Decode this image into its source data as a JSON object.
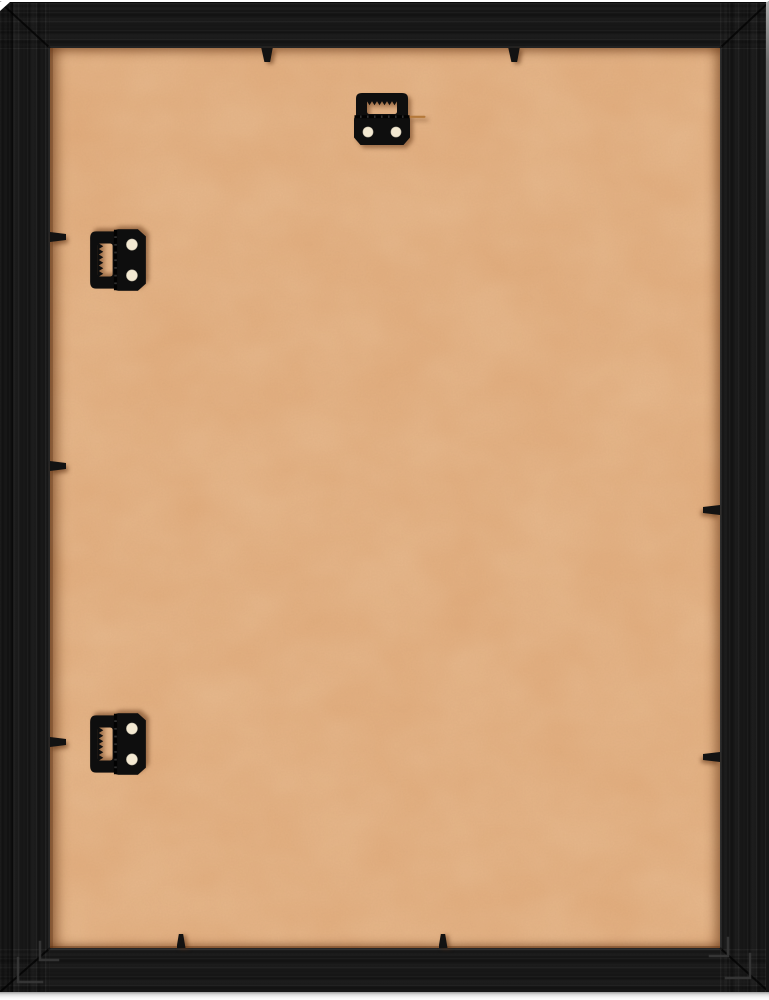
{
  "scene": {
    "description": "Back view of a black wood picture frame: a tan MDF backing board is held in by small black flex tabs around the opening; one horizontal sawtooth hanger is mounted at top center and two vertical sawtooth hangers along the left edge; v-nail staples are visible at the mitered corners; white backdrop shows as thin slivers at the top and bottom edges.",
    "colors": {
      "background": "#ffffff",
      "frame": "#181818",
      "backing": "#e0aa7b",
      "hardware": "#0e0e0e",
      "screw_hole": "#f3e9d2",
      "spur": "#b5793a",
      "v_nail": "#3a3a3a",
      "miter": "rgba(0,0,0,0.7)"
    },
    "frame": {
      "rect": {
        "x": 0,
        "y": 2,
        "w": 769,
        "h": 990
      },
      "face": {
        "left": 50,
        "top": 46,
        "right": 49,
        "bottom": 44
      },
      "miters": [
        [
          0,
          2,
          50,
          48
        ],
        [
          769,
          2,
          720,
          48
        ],
        [
          0,
          992,
          50,
          948
        ],
        [
          769,
          992,
          720,
          948
        ]
      ]
    },
    "backing": {
      "rect": {
        "x": 50,
        "y": 48,
        "w": 670,
        "h": 900
      }
    },
    "tabs": [
      {
        "edge": "top",
        "cx": 267,
        "y": 48
      },
      {
        "edge": "top",
        "cx": 514,
        "y": 48
      },
      {
        "edge": "bottom",
        "cx": 181,
        "y": 948
      },
      {
        "edge": "bottom",
        "cx": 443,
        "y": 948
      },
      {
        "edge": "left",
        "x": 50,
        "cy": 237
      },
      {
        "edge": "left",
        "x": 50,
        "cy": 466
      },
      {
        "edge": "left",
        "x": 50,
        "cy": 742
      },
      {
        "edge": "right",
        "x": 720,
        "cy": 510
      },
      {
        "edge": "right",
        "x": 720,
        "cy": 757
      }
    ],
    "v_nails": [
      {
        "corner": "tl",
        "x": 64,
        "y": 58,
        "size": 24
      },
      {
        "corner": "tl",
        "x": 88,
        "y": 82,
        "size": 18
      },
      {
        "corner": "tr",
        "x": 705,
        "y": 58,
        "size": 24
      },
      {
        "corner": "tr",
        "x": 681,
        "y": 82,
        "size": 18
      },
      {
        "corner": "bl",
        "x": 18,
        "y": 982,
        "size": 24
      },
      {
        "corner": "bl",
        "x": 40,
        "y": 960,
        "size": 18
      },
      {
        "corner": "br",
        "x": 750,
        "y": 978,
        "size": 24
      },
      {
        "corner": "br",
        "x": 728,
        "y": 956,
        "size": 18
      }
    ],
    "hardware": [
      {
        "name": "sawtooth-hanger-top",
        "type": "sawtooth-hanger",
        "orientation": "horizontal",
        "rect": {
          "x": 352,
          "y": 91,
          "w": 74,
          "h": 56
        },
        "screw_holes": 2
      },
      {
        "name": "sawtooth-hanger-upper-left",
        "type": "sawtooth-hanger",
        "orientation": "vertical",
        "rect": {
          "x": 88,
          "y": 227,
          "w": 60,
          "h": 66
        },
        "screw_holes": 2
      },
      {
        "name": "sawtooth-hanger-lower-left",
        "type": "sawtooth-hanger",
        "orientation": "vertical",
        "rect": {
          "x": 88,
          "y": 711,
          "w": 60,
          "h": 66
        },
        "screw_holes": 2
      }
    ]
  }
}
